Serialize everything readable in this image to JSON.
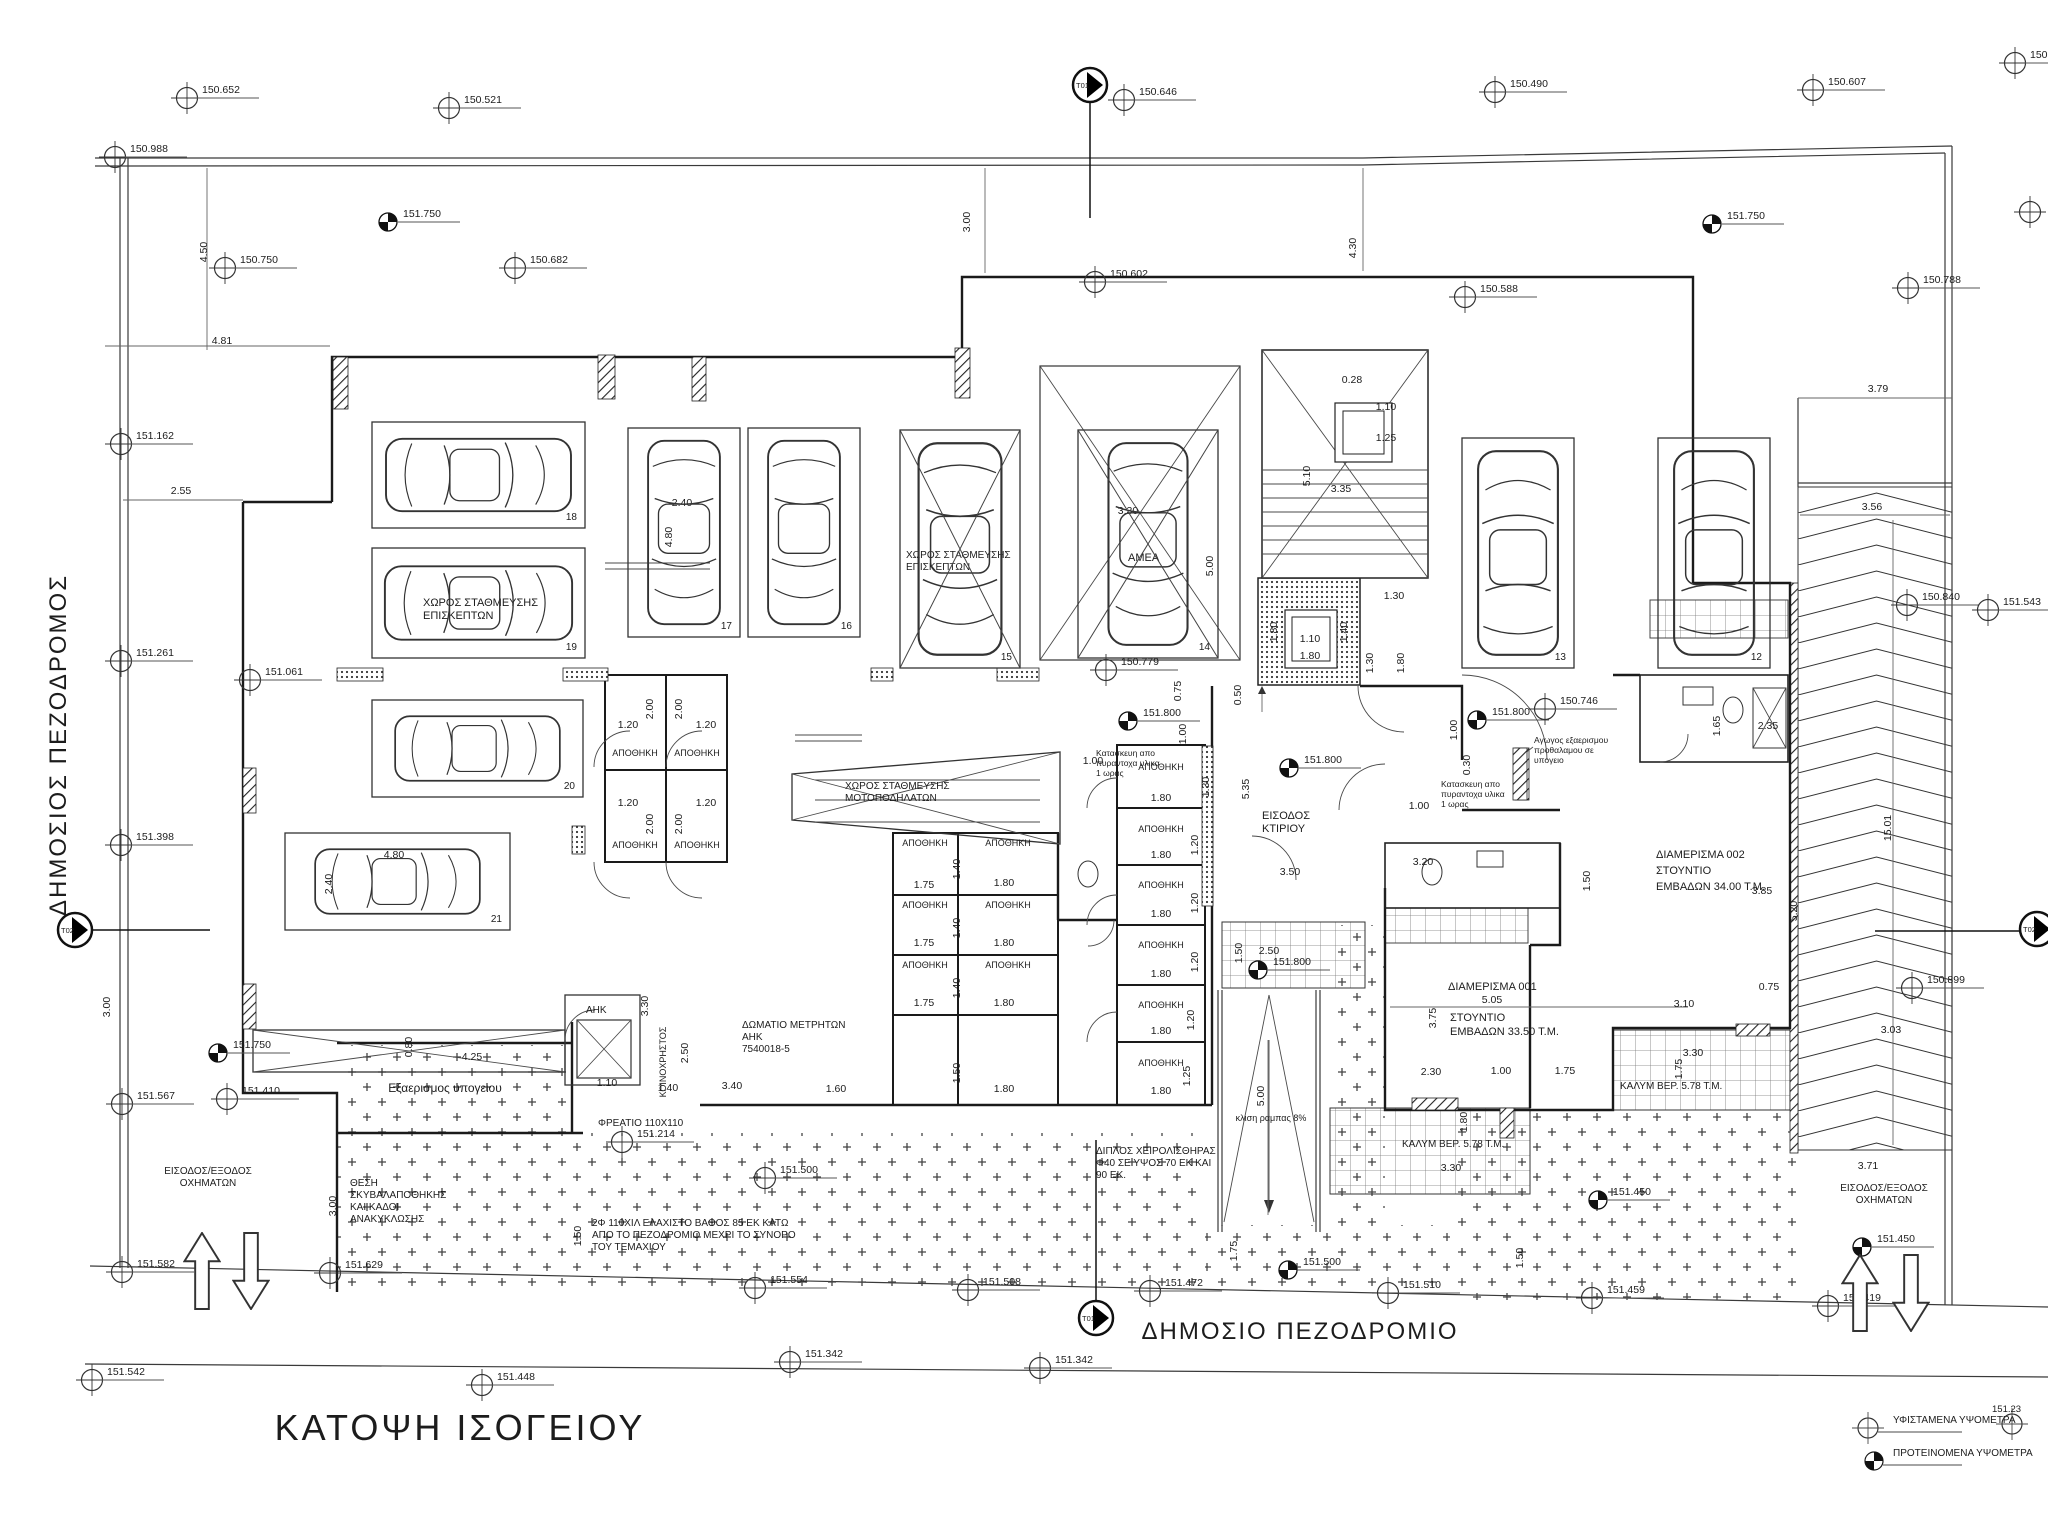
{
  "title": "ΚΑΤΟΨΗ ΙΣΟΓΕΙΟΥ",
  "streets": {
    "left": "ΔΗΜΟΣΙΟΣ ΠΕΖΟΔΡΟΜΟΣ",
    "bottom": "ΔΗΜΟΣΙΟ ΠΕΖΟΔΡΟΜΙΟ"
  },
  "legend": {
    "existing": "ΥΦΙΣΤΑΜΕΝΑ ΥΨΟΜΕΤΡΑ",
    "proposed": "ΠΡΟΤΕΙΝΟΜΕΝΑ ΥΨΟΜΕΤΡΑ",
    "corner_value": "151.23"
  },
  "section_markers": [
    {
      "id": "T01",
      "x": 1090,
      "y": 85,
      "l": [
        1090,
        103,
        1090,
        218
      ]
    },
    {
      "id": "T01",
      "x": 1096,
      "y": 1318,
      "l": [
        1096,
        1140,
        1096,
        1301
      ]
    },
    {
      "id": "T02",
      "x": 75,
      "y": 930,
      "l": [
        92,
        930,
        210,
        930
      ]
    },
    {
      "id": "T02",
      "x": 2037,
      "y": 929,
      "l": [
        1875,
        931,
        2020,
        931
      ]
    }
  ],
  "survey_points": [
    {
      "v": "150.652",
      "x": 187,
      "y": 98,
      "t": "e"
    },
    {
      "v": "150.521",
      "x": 449,
      "y": 108,
      "t": "e"
    },
    {
      "v": "150.646",
      "x": 1124,
      "y": 100,
      "t": "e"
    },
    {
      "v": "150.490",
      "x": 1495,
      "y": 92,
      "t": "e"
    },
    {
      "v": "150.607",
      "x": 1813,
      "y": 90,
      "t": "e"
    },
    {
      "v": "150.79",
      "x": 2015,
      "y": 63,
      "t": "e"
    },
    {
      "v": "150.988",
      "x": 115,
      "y": 157,
      "t": "e"
    },
    {
      "v": "151.750",
      "x": 388,
      "y": 222,
      "t": "p"
    },
    {
      "v": "150.750",
      "x": 225,
      "y": 268,
      "t": "e"
    },
    {
      "v": "150.682",
      "x": 515,
      "y": 268,
      "t": "e"
    },
    {
      "v": "150.602",
      "x": 1095,
      "y": 282,
      "t": "e"
    },
    {
      "v": "150.588",
      "x": 1465,
      "y": 297,
      "t": "e"
    },
    {
      "v": "151.750",
      "x": 1712,
      "y": 224,
      "t": "p"
    },
    {
      "v": "150.788",
      "x": 1908,
      "y": 288,
      "t": "e"
    },
    {
      "v": "",
      "x": 2030,
      "y": 212,
      "t": "e"
    },
    {
      "v": "151.162",
      "x": 121,
      "y": 444,
      "t": "e"
    },
    {
      "v": "151.261",
      "x": 121,
      "y": 661,
      "t": "e"
    },
    {
      "v": "151.398",
      "x": 121,
      "y": 845,
      "t": "e"
    },
    {
      "v": "151.061",
      "x": 250,
      "y": 680,
      "t": "e"
    },
    {
      "v": "150.779",
      "x": 1106,
      "y": 670,
      "t": "e"
    },
    {
      "v": "151.800",
      "x": 1128,
      "y": 721,
      "t": "p"
    },
    {
      "v": "151.800",
      "x": 1289,
      "y": 768,
      "t": "p"
    },
    {
      "v": "151.800",
      "x": 1477,
      "y": 720,
      "t": "p"
    },
    {
      "v": "150.746",
      "x": 1545,
      "y": 709,
      "t": "e"
    },
    {
      "v": "151.800",
      "x": 1258,
      "y": 970,
      "t": "p"
    },
    {
      "v": "150.840",
      "x": 1907,
      "y": 605,
      "t": "e"
    },
    {
      "v": "151.543",
      "x": 1988,
      "y": 610,
      "t": "e"
    },
    {
      "v": "150.899",
      "x": 1912,
      "y": 988,
      "t": "e"
    },
    {
      "v": "151.750",
      "x": 218,
      "y": 1053,
      "t": "p"
    },
    {
      "v": "151.567",
      "x": 122,
      "y": 1104,
      "t": "e"
    },
    {
      "v": "151.410",
      "x": 227,
      "y": 1099,
      "t": "e"
    },
    {
      "v": "151.214",
      "x": 622,
      "y": 1142,
      "t": "e"
    },
    {
      "v": "151.582",
      "x": 122,
      "y": 1272,
      "t": "e"
    },
    {
      "v": "151.629",
      "x": 330,
      "y": 1273,
      "t": "e"
    },
    {
      "v": "151.542",
      "x": 92,
      "y": 1380,
      "t": "e"
    },
    {
      "v": "151.448",
      "x": 482,
      "y": 1385,
      "t": "e"
    },
    {
      "v": "151.342",
      "x": 790,
      "y": 1362,
      "t": "e"
    },
    {
      "v": "151.342",
      "x": 1040,
      "y": 1368,
      "t": "e"
    },
    {
      "v": "151.500",
      "x": 765,
      "y": 1178,
      "t": "e"
    },
    {
      "v": "151.554",
      "x": 755,
      "y": 1288,
      "t": "e"
    },
    {
      "v": "151.508",
      "x": 968,
      "y": 1290,
      "t": "e"
    },
    {
      "v": "151.472",
      "x": 1150,
      "y": 1291,
      "t": "e"
    },
    {
      "v": "151.500",
      "x": 1288,
      "y": 1270,
      "t": "p"
    },
    {
      "v": "151.510",
      "x": 1388,
      "y": 1293,
      "t": "e"
    },
    {
      "v": "151.459",
      "x": 1592,
      "y": 1298,
      "t": "e"
    },
    {
      "v": "151.450",
      "x": 1598,
      "y": 1200,
      "t": "p"
    },
    {
      "v": "151.450",
      "x": 1862,
      "y": 1247,
      "t": "p"
    },
    {
      "v": "151.419",
      "x": 1828,
      "y": 1306,
      "t": "e"
    }
  ],
  "labels": [
    {
      "t": "ΧΩΡΟΣ ΣΤΑΘΜΕΥΣΗΣ\nΕΠΙΣΚΕΠΤΩΝ",
      "x": 423,
      "y": 606,
      "s": 11,
      "a": "s",
      "lh": 13
    },
    {
      "t": "ΧΩΡΟΣ ΣΤΑΘΜΕΥΣΗΣ\nΕΠΙΣΚΕΠΤΩΝ",
      "x": 906,
      "y": 558,
      "s": 10,
      "a": "s",
      "lh": 12
    },
    {
      "t": "ΑΜΕΑ",
      "x": 1128,
      "y": 561,
      "s": 11,
      "a": "s"
    },
    {
      "t": "ΧΩΡΟΣ ΣΤΑΘΜΕΥΣΗΣ\nΜΟΤΟΠΟΔΗΛΑΤΩΝ",
      "x": 845,
      "y": 789,
      "s": 10,
      "a": "s",
      "lh": 12
    },
    {
      "t": "ΕΙΣΟΔΟΣ\nΚΤΙΡΙΟΥ",
      "x": 1262,
      "y": 819,
      "s": 11,
      "a": "s",
      "lh": 13
    },
    {
      "t": "ΔΙΑΜΕΡΙΣΜΑ 002\nΣΤΟΥΝΤΙΟ\nΕΜΒΑΔΩΝ 34.00 Τ.Μ.",
      "x": 1656,
      "y": 858,
      "s": 11,
      "a": "s",
      "lh": 16
    },
    {
      "t": "ΔΙΑΜΕΡΙΣΜΑ 001",
      "x": 1448,
      "y": 990,
      "s": 11,
      "a": "s"
    },
    {
      "t": "ΣΤΟΥΝΤΙΟ\nΕΜΒΑΔΩΝ 33.50 Τ.Μ.",
      "x": 1450,
      "y": 1021,
      "s": 11,
      "a": "s",
      "lh": 14
    },
    {
      "t": "ΚΑΛΥΜ ΒΕΡ. 5.78 Τ.Μ.",
      "x": 1620,
      "y": 1089,
      "s": 10,
      "a": "s"
    },
    {
      "t": "ΚΑΛΥΜ ΒΕΡ. 5.78 Τ.Μ.",
      "x": 1402,
      "y": 1147,
      "s": 10,
      "a": "s"
    },
    {
      "t": "Εξαερισμος υπογειου",
      "x": 445,
      "y": 1092,
      "s": 12,
      "a": "m"
    },
    {
      "t": "ΑΗΚ",
      "x": 586,
      "y": 1013,
      "s": 10,
      "a": "s"
    },
    {
      "t": "ΔΩΜΑΤΙΟ ΜΕΤΡΗΤΩΝ\nΑΗΚ\n7540018-5",
      "x": 742,
      "y": 1028,
      "s": 10,
      "a": "s",
      "lh": 12
    },
    {
      "t": "ΦΡΕΑΤΙΟ 110Χ110",
      "x": 598,
      "y": 1126,
      "s": 10,
      "a": "s"
    },
    {
      "t": "κλιση ραμπας 8%",
      "x": 1271,
      "y": 1121,
      "s": 9,
      "a": "m"
    },
    {
      "t": "ΔΙΠΛΟΣ ΧΕΙΡΟΛΙΣΘΗΡΑΣ\nΦ40 ΣΕ ΥΨΟΣ 70 ΕΚ ΚΑΙ\n90 ΕΚ.",
      "x": 1096,
      "y": 1154,
      "s": 10,
      "a": "s",
      "lh": 12
    },
    {
      "t": "2Φ 110ΧΙΛ ΕΛΑΧΙΣΤΟ ΒΑΘΟΣ 85 ΕΚ ΚΑΤΩ\nΑΠΟ ΤΟ ΠΕΖΟΔΡΟΜΙΟ ΜΕΧΡΙ ΤΟ ΣΥΝΟΡΟ\nΤΟΥ ΤΕΜΑΧΙΟΥ",
      "x": 592,
      "y": 1226,
      "s": 10,
      "a": "s",
      "lh": 12
    },
    {
      "t": "ΘΕΣΗ\nΣΚΥΒΑΛΑΠΟΘΗΚΗΣ\nΚΑΙ ΚΑΔΟΙ\nΑΝΑΚΥΚΛΩΣΗΣ",
      "x": 350,
      "y": 1186,
      "s": 10,
      "a": "s",
      "lh": 12
    },
    {
      "t": "ΕΙΣΟΔΟΣ/ΕΞΟΔΟΣ\nΟΧΗΜΑΤΩΝ",
      "x": 208,
      "y": 1174,
      "s": 10,
      "a": "m",
      "lh": 12
    },
    {
      "t": "ΕΙΣΟΔΟΣ/ΕΞΟΔΟΣ\nΟΧΗΜΑΤΩΝ",
      "x": 1884,
      "y": 1191,
      "s": 10,
      "a": "m",
      "lh": 12
    },
    {
      "t": "Αγωγος εξαερισμου\nπροθαλαμου σε\nυπογειο",
      "x": 1534,
      "y": 743,
      "s": 8.5,
      "a": "s",
      "lh": 10
    },
    {
      "t": "Κατασκευη απο\nπυραντοχα υλικα\n1 ωρας",
      "x": 1096,
      "y": 756,
      "s": 8.5,
      "a": "s",
      "lh": 10
    },
    {
      "t": "Κατασκευη απο\nπυραντοχα υλικα\n1 ωρας",
      "x": 1441,
      "y": 787,
      "s": 8.5,
      "a": "s",
      "lh": 10
    },
    {
      "t": "ΚΟΙΝΟΧΡΗΣΤΟΣ",
      "x": 666,
      "y": 1062,
      "s": 9,
      "a": "m",
      "r": -90
    },
    {
      "t": "ΑΠΟΘΗΚΗ",
      "x": 635,
      "y": 756,
      "s": 9,
      "a": "m"
    },
    {
      "t": "ΑΠΟΘΗΚΗ",
      "x": 697,
      "y": 756,
      "s": 9,
      "a": "m"
    },
    {
      "t": "ΑΠΟΘΗΚΗ",
      "x": 635,
      "y": 848,
      "s": 9,
      "a": "m"
    },
    {
      "t": "ΑΠΟΘΗΚΗ",
      "x": 697,
      "y": 848,
      "s": 9,
      "a": "m"
    },
    {
      "t": "ΑΠΟΘΗΚΗ",
      "x": 925,
      "y": 846,
      "s": 9,
      "a": "m"
    },
    {
      "t": "ΑΠΟΘΗΚΗ",
      "x": 1008,
      "y": 846,
      "s": 9,
      "a": "m"
    },
    {
      "t": "ΑΠΟΘΗΚΗ",
      "x": 925,
      "y": 908,
      "s": 9,
      "a": "m"
    },
    {
      "t": "ΑΠΟΘΗΚΗ",
      "x": 1008,
      "y": 908,
      "s": 9,
      "a": "m"
    },
    {
      "t": "ΑΠΟΘΗΚΗ",
      "x": 925,
      "y": 968,
      "s": 9,
      "a": "m"
    },
    {
      "t": "ΑΠΟΘΗΚΗ",
      "x": 1008,
      "y": 968,
      "s": 9,
      "a": "m"
    },
    {
      "t": "ΑΠΟΘΗΚΗ",
      "x": 1161,
      "y": 770,
      "s": 9,
      "a": "m"
    },
    {
      "t": "ΑΠΟΘΗΚΗ",
      "x": 1161,
      "y": 832,
      "s": 9,
      "a": "m"
    },
    {
      "t": "ΑΠΟΘΗΚΗ",
      "x": 1161,
      "y": 888,
      "s": 9,
      "a": "m"
    },
    {
      "t": "ΑΠΟΘΗΚΗ",
      "x": 1161,
      "y": 948,
      "s": 9,
      "a": "m"
    },
    {
      "t": "ΑΠΟΘΗΚΗ",
      "x": 1161,
      "y": 1008,
      "s": 9,
      "a": "m"
    },
    {
      "t": "ΑΠΟΘΗΚΗ",
      "x": 1161,
      "y": 1066,
      "s": 9,
      "a": "m"
    }
  ],
  "dims": [
    {
      "t": "4.50",
      "x": 207,
      "y": 252,
      "r": 1
    },
    {
      "t": "3.00",
      "x": 970,
      "y": 222,
      "r": 1
    },
    {
      "t": "4.30",
      "x": 1356,
      "y": 248,
      "r": 1
    },
    {
      "t": "4.81",
      "x": 222,
      "y": 344
    },
    {
      "t": "2.55",
      "x": 181,
      "y": 494
    },
    {
      "t": "3.79",
      "x": 1878,
      "y": 392
    },
    {
      "t": "3.56",
      "x": 1872,
      "y": 510
    },
    {
      "t": "2.40",
      "x": 682,
      "y": 506
    },
    {
      "t": "4.80",
      "x": 672,
      "y": 537,
      "r": 1
    },
    {
      "t": "3.30",
      "x": 1128,
      "y": 514
    },
    {
      "t": "5.00",
      "x": 1213,
      "y": 566,
      "r": 1
    },
    {
      "t": "0.28",
      "x": 1352,
      "y": 383
    },
    {
      "t": "1.10",
      "x": 1386,
      "y": 410
    },
    {
      "t": "1.25",
      "x": 1386,
      "y": 441
    },
    {
      "t": "3.35",
      "x": 1341,
      "y": 492
    },
    {
      "t": "5.10",
      "x": 1310,
      "y": 476,
      "r": 1
    },
    {
      "t": "2.40",
      "x": 332,
      "y": 884,
      "r": 1
    },
    {
      "t": "4.80",
      "x": 394,
      "y": 858
    },
    {
      "t": "1.10",
      "x": 1310,
      "y": 642
    },
    {
      "t": "1.80",
      "x": 1310,
      "y": 659
    },
    {
      "t": "1.80",
      "x": 1277,
      "y": 632,
      "r": 1
    },
    {
      "t": "1.40",
      "x": 1347,
      "y": 632,
      "r": 1
    },
    {
      "t": "1.30",
      "x": 1394,
      "y": 599
    },
    {
      "t": "1.30",
      "x": 1373,
      "y": 663,
      "r": 1
    },
    {
      "t": "1.80",
      "x": 1404,
      "y": 663,
      "r": 1
    },
    {
      "t": "0.75",
      "x": 1181,
      "y": 691,
      "r": 1
    },
    {
      "t": "1.00",
      "x": 1186,
      "y": 734,
      "r": 1
    },
    {
      "t": "0.50",
      "x": 1241,
      "y": 695,
      "r": 1
    },
    {
      "t": "5.35",
      "x": 1249,
      "y": 789,
      "r": 1
    },
    {
      "t": "3.50",
      "x": 1290,
      "y": 875
    },
    {
      "t": "1.30",
      "x": 1209,
      "y": 787,
      "r": 1
    },
    {
      "t": "1.20",
      "x": 628,
      "y": 728
    },
    {
      "t": "1.20",
      "x": 706,
      "y": 728
    },
    {
      "t": "2.00",
      "x": 653,
      "y": 709,
      "r": 1
    },
    {
      "t": "2.00",
      "x": 682,
      "y": 709,
      "r": 1
    },
    {
      "t": "1.20",
      "x": 628,
      "y": 806
    },
    {
      "t": "1.20",
      "x": 706,
      "y": 806
    },
    {
      "t": "2.00",
      "x": 653,
      "y": 824,
      "r": 1
    },
    {
      "t": "2.00",
      "x": 682,
      "y": 824,
      "r": 1
    },
    {
      "t": "1.75",
      "x": 924,
      "y": 888
    },
    {
      "t": "1.80",
      "x": 1004,
      "y": 886
    },
    {
      "t": "1.40",
      "x": 960,
      "y": 869,
      "r": 1
    },
    {
      "t": "1.75",
      "x": 924,
      "y": 946
    },
    {
      "t": "1.80",
      "x": 1004,
      "y": 946
    },
    {
      "t": "1.40",
      "x": 960,
      "y": 928,
      "r": 1
    },
    {
      "t": "1.75",
      "x": 924,
      "y": 1006
    },
    {
      "t": "1.80",
      "x": 1004,
      "y": 1006
    },
    {
      "t": "1.40",
      "x": 960,
      "y": 988,
      "r": 1
    },
    {
      "t": "1.60",
      "x": 836,
      "y": 1092
    },
    {
      "t": "1.80",
      "x": 1004,
      "y": 1092
    },
    {
      "t": "1.50",
      "x": 960,
      "y": 1073,
      "r": 1
    },
    {
      "t": "1.10",
      "x": 607,
      "y": 1086
    },
    {
      "t": "1.40",
      "x": 668,
      "y": 1091
    },
    {
      "t": "3.40",
      "x": 732,
      "y": 1089
    },
    {
      "t": "1.80",
      "x": 1161,
      "y": 801
    },
    {
      "t": "1.80",
      "x": 1161,
      "y": 858
    },
    {
      "t": "1.20",
      "x": 1198,
      "y": 845,
      "r": 1
    },
    {
      "t": "1.80",
      "x": 1161,
      "y": 917
    },
    {
      "t": "1.20",
      "x": 1198,
      "y": 903,
      "r": 1
    },
    {
      "t": "1.80",
      "x": 1161,
      "y": 977
    },
    {
      "t": "1.20",
      "x": 1198,
      "y": 962,
      "r": 1
    },
    {
      "t": "1.80",
      "x": 1161,
      "y": 1034
    },
    {
      "t": "1.20",
      "x": 1194,
      "y": 1020,
      "r": 1
    },
    {
      "t": "1.80",
      "x": 1161,
      "y": 1094
    },
    {
      "t": "1.25",
      "x": 1190,
      "y": 1076,
      "r": 1
    },
    {
      "t": "0.80",
      "x": 412,
      "y": 1047,
      "r": 1
    },
    {
      "t": "4.25",
      "x": 472,
      "y": 1060
    },
    {
      "t": "3.30",
      "x": 648,
      "y": 1006,
      "r": 1
    },
    {
      "t": "2.50",
      "x": 688,
      "y": 1053,
      "r": 1
    },
    {
      "t": "1.50",
      "x": 581,
      "y": 1236,
      "r": 1
    },
    {
      "t": "2.50",
      "x": 1269,
      "y": 954
    },
    {
      "t": "1.50",
      "x": 1242,
      "y": 953,
      "r": 1
    },
    {
      "t": "5.00",
      "x": 1264,
      "y": 1096,
      "r": 1
    },
    {
      "t": "1.75",
      "x": 1237,
      "y": 1251,
      "r": 1
    },
    {
      "t": "5.05",
      "x": 1492,
      "y": 1003
    },
    {
      "t": "3.75",
      "x": 1436,
      "y": 1018,
      "r": 1
    },
    {
      "t": "2.30",
      "x": 1431,
      "y": 1075
    },
    {
      "t": "1.00",
      "x": 1501,
      "y": 1074
    },
    {
      "t": "1.75",
      "x": 1565,
      "y": 1074
    },
    {
      "t": "3.30",
      "x": 1451,
      "y": 1171
    },
    {
      "t": "1.80",
      "x": 1467,
      "y": 1122,
      "r": 1
    },
    {
      "t": "3.20",
      "x": 1423,
      "y": 865
    },
    {
      "t": "1.50",
      "x": 1590,
      "y": 881,
      "r": 1
    },
    {
      "t": "1.00",
      "x": 1419,
      "y": 809
    },
    {
      "t": "3.10",
      "x": 1684,
      "y": 1007
    },
    {
      "t": "0.75",
      "x": 1769,
      "y": 990
    },
    {
      "t": "3.30",
      "x": 1693,
      "y": 1056
    },
    {
      "t": "1.75",
      "x": 1682,
      "y": 1069,
      "r": 1
    },
    {
      "t": "3.85",
      "x": 1762,
      "y": 894
    },
    {
      "t": "5.20",
      "x": 1797,
      "y": 911,
      "r": 1
    },
    {
      "t": "2.35",
      "x": 1768,
      "y": 729
    },
    {
      "t": "1.65",
      "x": 1720,
      "y": 726,
      "r": 1
    },
    {
      "t": "1.00",
      "x": 1457,
      "y": 730,
      "r": 1
    },
    {
      "t": "0.30",
      "x": 1470,
      "y": 765,
      "r": 1
    },
    {
      "t": "1.00",
      "x": 1093,
      "y": 764
    },
    {
      "t": "15.01",
      "x": 1891,
      "y": 828,
      "r": 1
    },
    {
      "t": "3.03",
      "x": 1891,
      "y": 1033
    },
    {
      "t": "3.71",
      "x": 1868,
      "y": 1169
    },
    {
      "t": "3.00",
      "x": 110,
      "y": 1007,
      "r": 1
    },
    {
      "t": "3.00",
      "x": 336,
      "y": 1206,
      "r": 1
    },
    {
      "t": "1.50",
      "x": 1523,
      "y": 1258,
      "r": 1
    }
  ],
  "stalls": [
    {
      "n": "18",
      "x": 372,
      "y": 422,
      "w": 213,
      "h": 106,
      "o": "h"
    },
    {
      "n": "19",
      "x": 372,
      "y": 548,
      "w": 213,
      "h": 110,
      "o": "h"
    },
    {
      "n": "20",
      "x": 372,
      "y": 700,
      "w": 211,
      "h": 97,
      "o": "h"
    },
    {
      "n": "21",
      "x": 285,
      "y": 833,
      "w": 225,
      "h": 97,
      "o": "h"
    },
    {
      "n": "17",
      "x": 628,
      "y": 428,
      "w": 112,
      "h": 209,
      "o": "v"
    },
    {
      "n": "16",
      "x": 748,
      "y": 428,
      "w": 112,
      "h": 209,
      "o": "v"
    },
    {
      "n": "15",
      "x": 900,
      "y": 430,
      "w": 120,
      "h": 238,
      "o": "v",
      "cross": true
    },
    {
      "n": "14",
      "x": 1078,
      "y": 430,
      "w": 140,
      "h": 228,
      "o": "v",
      "cross": true
    },
    {
      "n": "13",
      "x": 1462,
      "y": 438,
      "w": 112,
      "h": 230,
      "o": "vu"
    },
    {
      "n": "12",
      "x": 1658,
      "y": 438,
      "w": 112,
      "h": 230,
      "o": "vu"
    }
  ],
  "arrows": [
    {
      "x": 202,
      "y": 1232,
      "d": "u"
    },
    {
      "x": 251,
      "y": 1232,
      "d": "d"
    },
    {
      "x": 1860,
      "y": 1254,
      "d": "u"
    },
    {
      "x": 1911,
      "y": 1254,
      "d": "d"
    }
  ]
}
